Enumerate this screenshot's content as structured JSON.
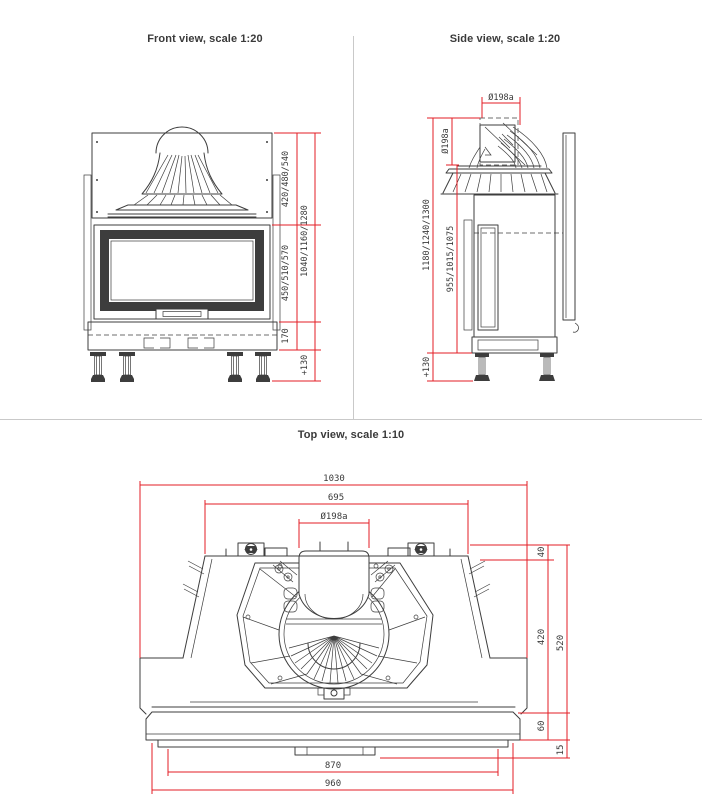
{
  "page": {
    "type": "fireplace-insert-technical-drawing",
    "background": "#ffffff"
  },
  "colors": {
    "dimension_lines": "#e31e24",
    "drawing_lines": "#3d3d3d",
    "text": "#3a3a3a",
    "divider": "#c9c9c9"
  },
  "views": {
    "front": {
      "title": "Front view, scale 1:20",
      "dims": {
        "hood_height": "420/480/540",
        "door_height": "450/510/570",
        "base_height": "170",
        "total_height": "1040/1160/1280",
        "legs_height": "+130"
      }
    },
    "side": {
      "title": "Side view, scale 1:20",
      "dims": {
        "flue_diameter_top": "Ø198a",
        "flue_diameter_side": "Ø198a",
        "total_height": "1180/1240/1300",
        "body_height": "955/1015/1075",
        "legs_height": "+130"
      }
    },
    "top": {
      "title": "Top view, scale 1:10",
      "dims": {
        "overall_width": "1030",
        "top_width": "695",
        "flue_diameter": "Ø198a",
        "back_depth": "40",
        "body_depth": "420",
        "total_depth": "520",
        "front_depth": "60",
        "lip_depth": "15",
        "front_inner_width": "870",
        "front_width": "960"
      }
    }
  }
}
